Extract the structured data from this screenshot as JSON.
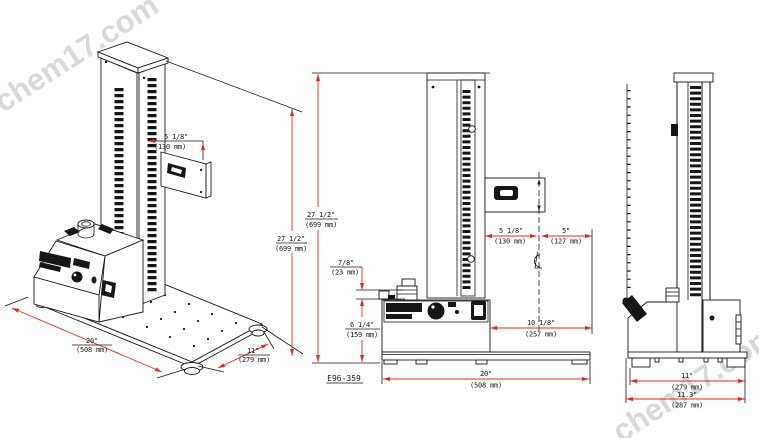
{
  "watermarks": {
    "top_left": "chem17.com",
    "bottom_right": "chem17.com"
  },
  "drawing_number": "E96-359",
  "centerline_symbol": "℄",
  "colors": {
    "line": "#161616",
    "dimension_red": "#e8251d",
    "watermark_gray": "#d8d8d8",
    "background": "#ffffff"
  },
  "views": {
    "isometric": {
      "dimensions": {
        "bracket_offset_in": "5 1/8\"",
        "bracket_offset_mm": "(130 mm)",
        "column_height_in": "27 1/2\"",
        "column_height_mm": "(699 mm)",
        "base_width_in": "20\"",
        "base_width_mm": "(508 mm)",
        "base_depth_in": "11\"",
        "base_depth_mm": "(279 mm)"
      }
    },
    "front": {
      "dimensions": {
        "column_height_in": "27 1/2\"",
        "column_height_mm": "(699 mm)",
        "knob_height_in": "7/8\"",
        "knob_height_mm": "(23 mm)",
        "panel_height_in": "6 1/4\"",
        "panel_height_mm": "(159 mm)",
        "column_to_center_in": "5 1/8\"",
        "column_to_center_mm": "(130 mm)",
        "center_to_edge_in": "5\"",
        "center_to_edge_mm": "(127 mm)",
        "center_to_base_edge_in": "10 1/8\"",
        "center_to_base_edge_mm": "(257 mm)",
        "base_width_in": "20\"",
        "base_width_mm": "(508 mm)"
      }
    },
    "side": {
      "dimensions": {
        "feet_depth_in": "11\"",
        "feet_depth_mm": "(279 mm)",
        "overall_depth_in": "11.3\"",
        "overall_depth_mm": "(287 mm)"
      }
    }
  }
}
